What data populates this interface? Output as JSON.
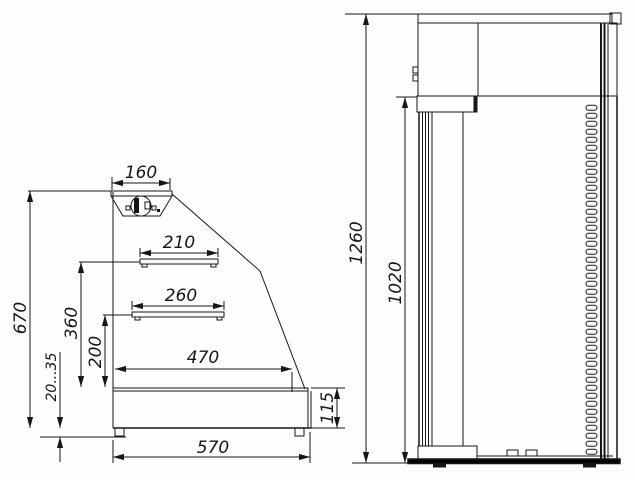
{
  "colors": {
    "background": "#fdfdfd",
    "ink": "#161616"
  },
  "side_view": {
    "dimensions": {
      "canopy_width": "160",
      "upper_shelf_length": "210",
      "middle_shelf_length": "260",
      "deck_length": "470",
      "base_width": "570",
      "body_height": "670",
      "upper_shelf_height": "360",
      "middle_shelf_height": "200",
      "foot_adjustment": "20...35",
      "base_height": "115"
    }
  },
  "front_view": {
    "dimensions": {
      "overall_height": "1260",
      "stand_height": "1020"
    }
  }
}
